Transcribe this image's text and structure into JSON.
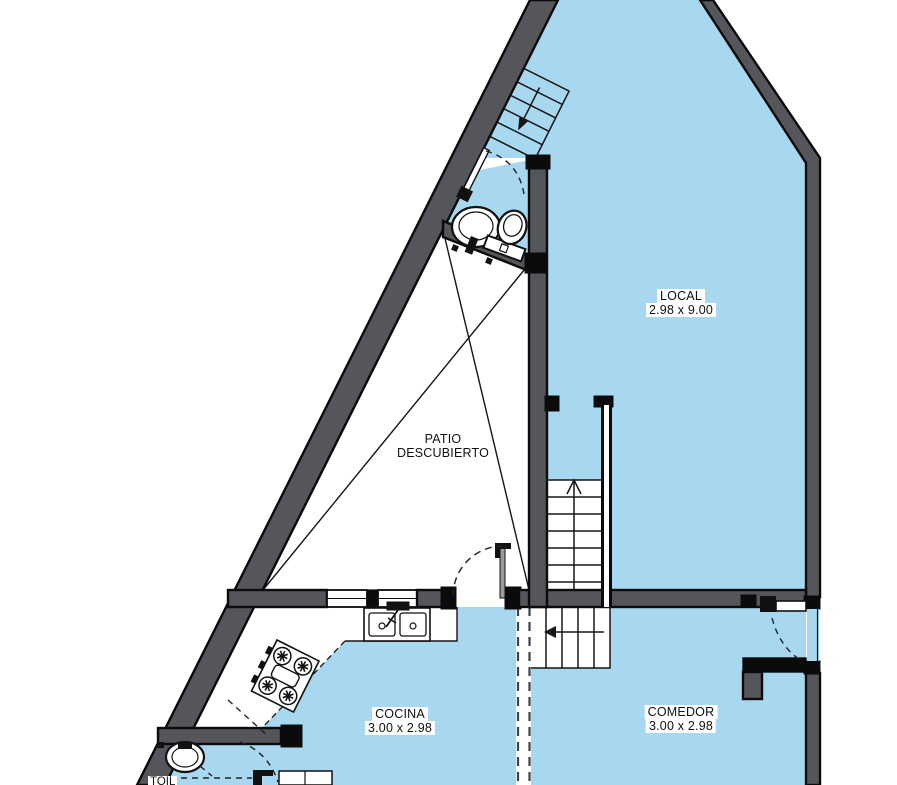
{
  "plan": {
    "title": "floor-plan",
    "rooms": {
      "local": {
        "name": "LOCAL",
        "dims": "2.98 x 9.00"
      },
      "patio": {
        "name_line1": "PATIO",
        "name_line2": "DESCUBIERTO"
      },
      "cocina": {
        "name": "COCINA",
        "dims": "3.00 x 2.98"
      },
      "comedor": {
        "name": "COMEDOR",
        "dims": "3.00 x 2.98"
      },
      "toilette": {
        "name": "TOIL"
      }
    },
    "colors": {
      "floor": "#A8D7F0",
      "wall": "#55565B",
      "outline": "#0B0B0B",
      "paper": "#FFFFFF"
    }
  }
}
